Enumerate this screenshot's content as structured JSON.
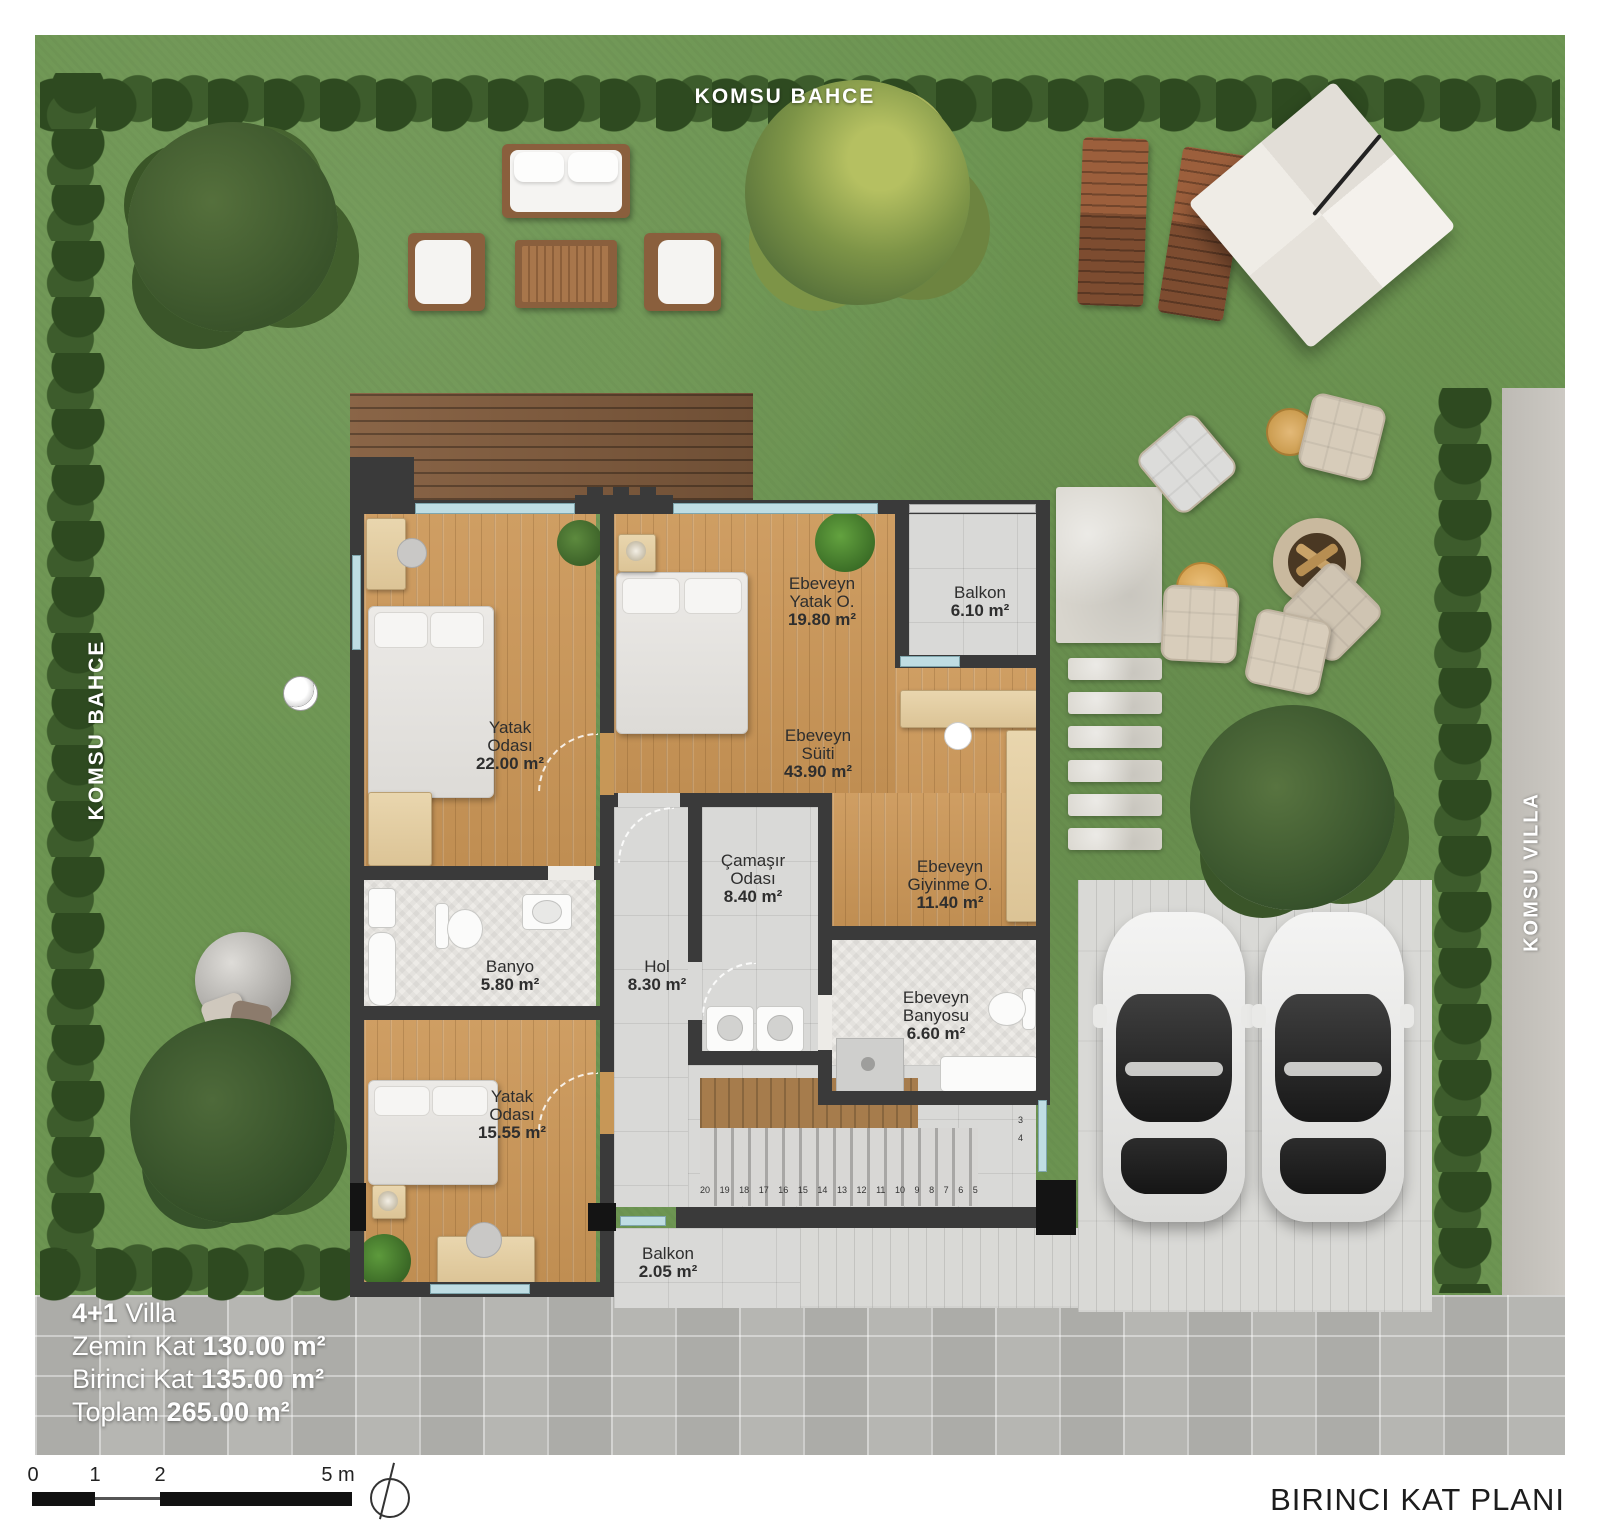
{
  "site_labels": {
    "top": "KOMSU BAHCE",
    "left": "KOMSU BAHCE",
    "right": "KOMSU VILLA"
  },
  "rooms": [
    {
      "id": "ebeveyn-yatak-odasi",
      "name": "Ebeveyn\nYatak O.",
      "area": "19.80 m²"
    },
    {
      "id": "balkon-ust",
      "name": "Balkon",
      "area": "6.10 m²"
    },
    {
      "id": "yatak-odasi-1",
      "name": "Yatak\nOdası",
      "area": "22.00 m²"
    },
    {
      "id": "ebeveyn-suiti",
      "name": "Ebeveyn\nSüiti",
      "area": "43.90 m²"
    },
    {
      "id": "camasir-odasi",
      "name": "Çamaşır\nOdası",
      "area": "8.40 m²"
    },
    {
      "id": "ebeveyn-giyinme",
      "name": "Ebeveyn\nGiyinme O.",
      "area": "11.40 m²"
    },
    {
      "id": "banyo",
      "name": "Banyo",
      "area": "5.80 m²"
    },
    {
      "id": "hol",
      "name": "Hol",
      "area": "8.30 m²"
    },
    {
      "id": "ebeveyn-banyosu",
      "name": "Ebeveyn\nBanyosu",
      "area": "6.60 m²"
    },
    {
      "id": "yatak-odasi-2",
      "name": "Yatak\nOdası",
      "area": "15.55 m²"
    },
    {
      "id": "balkon-alt",
      "name": "Balkon",
      "area": "2.05 m²"
    }
  ],
  "stairs": {
    "run_numbers": [
      "20",
      "19",
      "18",
      "17",
      "16",
      "15",
      "14",
      "13",
      "12",
      "11",
      "10",
      "9",
      "8",
      "7",
      "6",
      "5"
    ],
    "winder_numbers": [
      "2",
      "3",
      "4"
    ]
  },
  "info": {
    "line1_bold": "4+1",
    "line1_rest": " Villa",
    "line2_label": "Zemin Kat ",
    "line2_value": "130.00 m²",
    "line3_label": "Birinci Kat ",
    "line3_value": "135.00 m²",
    "line4_label": "Toplam ",
    "line4_value": "265.00 m²"
  },
  "scale_bar": {
    "ticks": [
      "0",
      "1",
      "2",
      "5 m"
    ]
  },
  "title": "BIRINCI KAT PLANI",
  "palette": {
    "grass": "#6d9552",
    "hedge1": "#2e4a20",
    "hedge2": "#3d5c2c",
    "wall": "#3a3a3a",
    "wood": "#c79757",
    "tile": "#d9d9d7",
    "herr": "#edebe7",
    "paver": "#b2b2ae",
    "deck": "#d9d9d6",
    "deckBrown": "#7c5a3e",
    "stone": "#d8d5cd",
    "glass": "#bfdde3",
    "label": "#2e2e2e",
    "cushion": "#d7ccba"
  }
}
